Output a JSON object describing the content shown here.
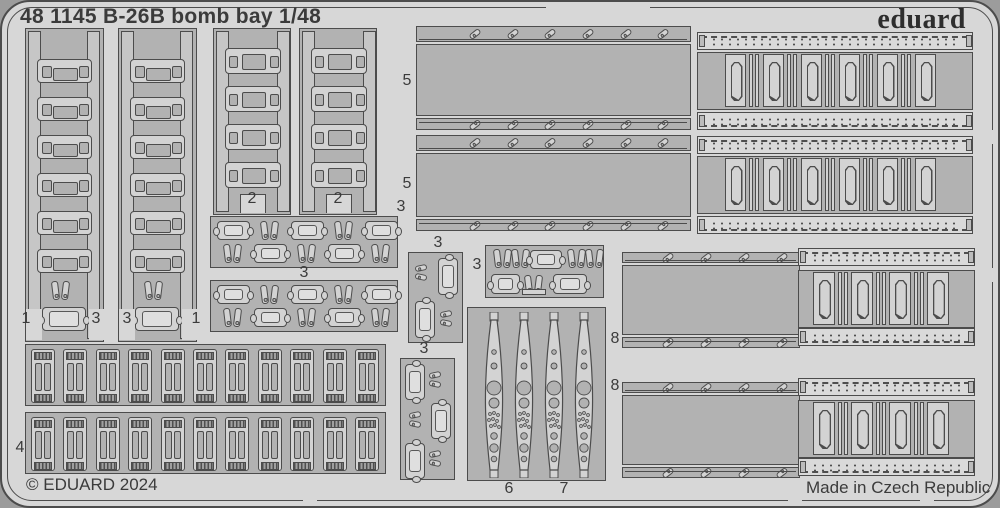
{
  "sheet": {
    "title": "48 1145 B-26B bomb bay 1/48",
    "brand": "eduard",
    "copyright": "© EDUARD 2024",
    "made_in": "Made in Czech Republic",
    "colors": {
      "background": "#d7d7d7",
      "carrier": "#b2b2b2",
      "part_light": "#d3d3d3",
      "outline": "#4c4c4c",
      "text": "#3b3b3b",
      "rivet_strip": "#dadada",
      "rail": "#c6c6c6",
      "outer_corner": "#9c9c9c"
    },
    "part_labels": [
      {
        "id": "plate-5-upper",
        "text": "5"
      },
      {
        "id": "plate-5-lower",
        "text": "5"
      },
      {
        "id": "rack-1-left",
        "text": "1"
      },
      {
        "id": "hook-3-left",
        "text": "3"
      },
      {
        "id": "hook-3-mid",
        "text": "3"
      },
      {
        "id": "rack-1-right",
        "text": "1"
      },
      {
        "id": "rack-2-left",
        "text": "2"
      },
      {
        "id": "rack-2-right",
        "text": "2"
      },
      {
        "id": "strip-3-upper",
        "text": "3"
      },
      {
        "id": "strip-3-lower",
        "text": "3"
      },
      {
        "id": "cluster-3-a",
        "text": "3"
      },
      {
        "id": "cluster-3-b",
        "text": "3"
      },
      {
        "id": "cluster-3-c",
        "text": "3"
      },
      {
        "id": "clips-4",
        "text": "4"
      },
      {
        "id": "blade-6",
        "text": "6"
      },
      {
        "id": "blade-7",
        "text": "7"
      },
      {
        "id": "door-8-upper",
        "text": "8"
      },
      {
        "id": "door-8-lower",
        "text": "8"
      }
    ]
  }
}
